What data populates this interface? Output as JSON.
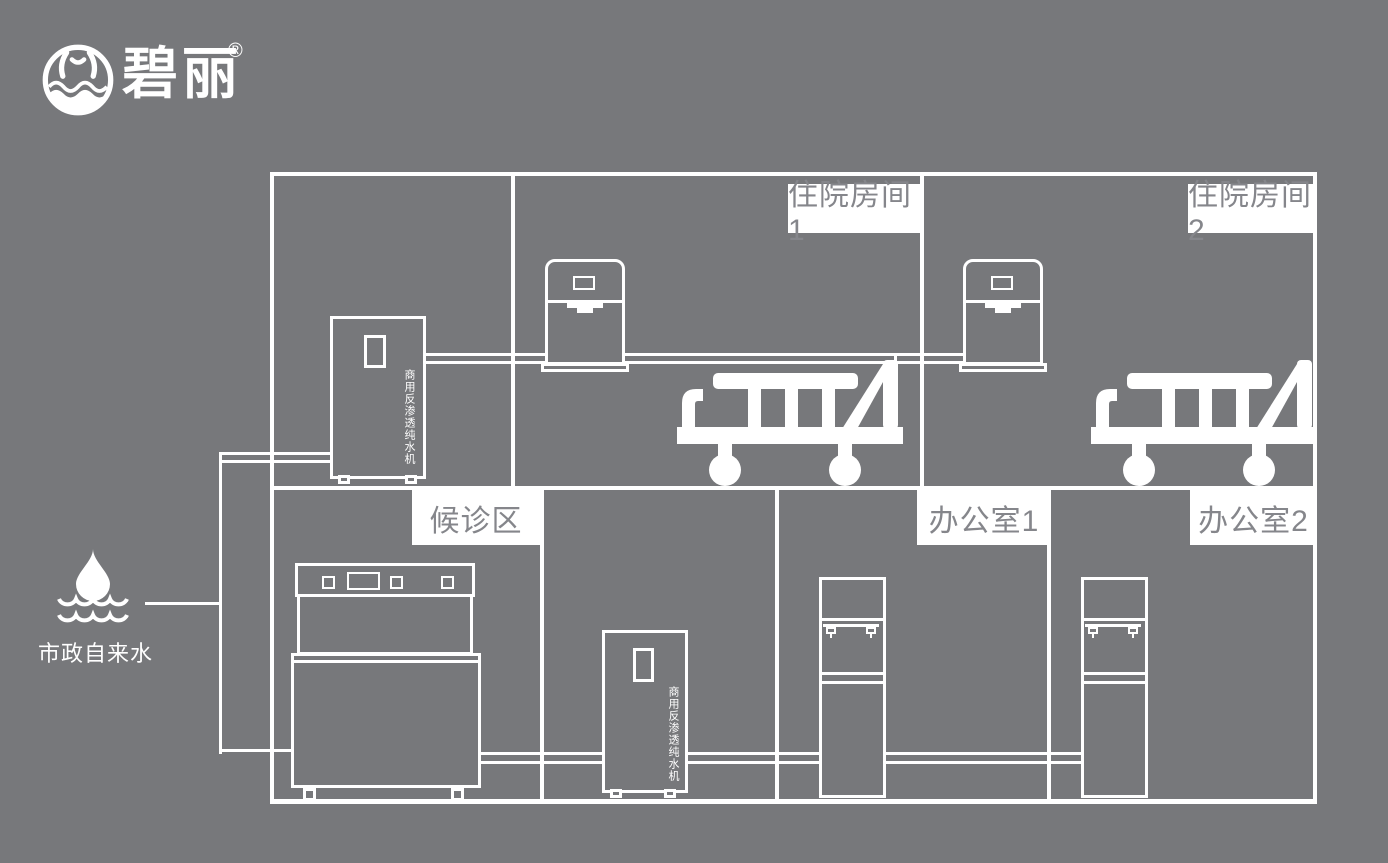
{
  "colors": {
    "background": "#77787b",
    "line_white": "#ffffff",
    "label_background": "#ffffff",
    "label_text": "#85868b"
  },
  "logo": {
    "brand": "碧丽",
    "registered_mark": "®"
  },
  "water_source": {
    "label": "市政自来水"
  },
  "rooms": {
    "inpatient1": {
      "label": "住院房间1"
    },
    "inpatient2": {
      "label": "住院房间2"
    },
    "waiting": {
      "label": "候诊区"
    },
    "office1": {
      "label": "办公室1"
    },
    "office2": {
      "label": "办公室2"
    }
  },
  "equipment": {
    "ro_machine_label": "商用反渗透纯水机"
  }
}
